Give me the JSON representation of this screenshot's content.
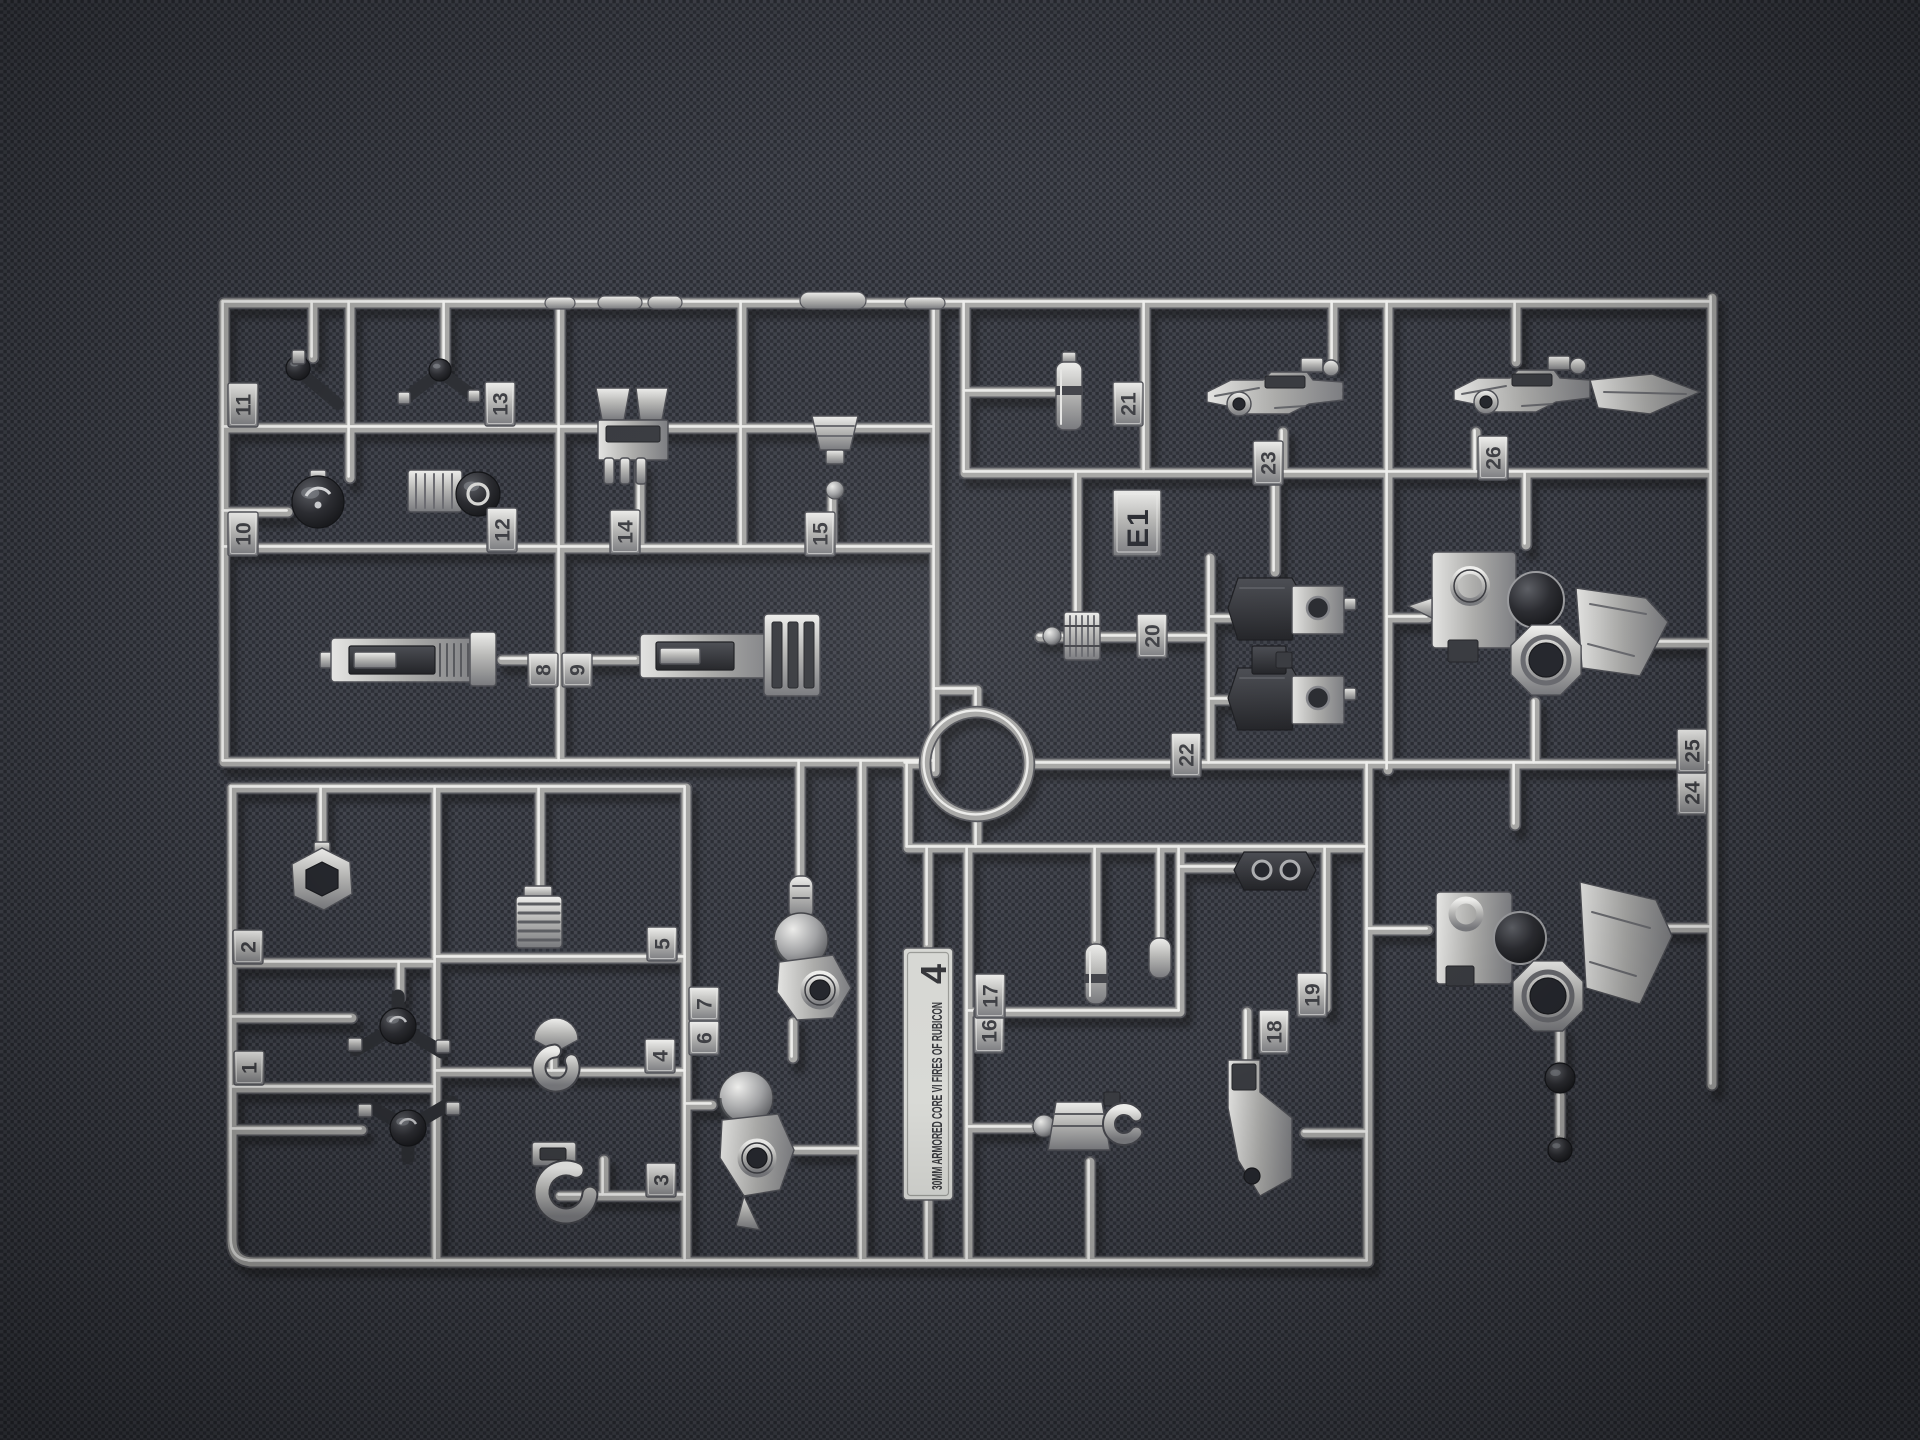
{
  "plate": {
    "series_title": "30MM ARMORED CORE VI FIRES OF RUBICON",
    "plate_number": "4"
  },
  "runner_code": "E1",
  "part_tabs": [
    {
      "label": "1",
      "x": 249,
      "y": 1068
    },
    {
      "label": "2",
      "x": 248,
      "y": 947
    },
    {
      "label": "3",
      "x": 661,
      "y": 1180
    },
    {
      "label": "4",
      "x": 660,
      "y": 1056
    },
    {
      "label": "5",
      "x": 662,
      "y": 944
    },
    {
      "label": "6",
      "x": 704,
      "y": 1038
    },
    {
      "label": "7",
      "x": 704,
      "y": 1004
    },
    {
      "label": "8",
      "x": 543,
      "y": 670
    },
    {
      "label": "9",
      "x": 577,
      "y": 670
    },
    {
      "label": "10",
      "x": 243,
      "y": 534
    },
    {
      "label": "11",
      "x": 243,
      "y": 405
    },
    {
      "label": "12",
      "x": 502,
      "y": 530
    },
    {
      "label": "13",
      "x": 500,
      "y": 404
    },
    {
      "label": "14",
      "x": 625,
      "y": 532
    },
    {
      "label": "15",
      "x": 820,
      "y": 534
    },
    {
      "label": "16",
      "x": 989,
      "y": 1031
    },
    {
      "label": "17",
      "x": 990,
      "y": 996
    },
    {
      "label": "18",
      "x": 1274,
      "y": 1032
    },
    {
      "label": "19",
      "x": 1312,
      "y": 995
    },
    {
      "label": "20",
      "x": 1152,
      "y": 636
    },
    {
      "label": "21",
      "x": 1128,
      "y": 404
    },
    {
      "label": "22",
      "x": 1186,
      "y": 755
    },
    {
      "label": "23",
      "x": 1268,
      "y": 463
    },
    {
      "label": "24",
      "x": 1692,
      "y": 793
    },
    {
      "label": "25",
      "x": 1692,
      "y": 751
    },
    {
      "label": "26",
      "x": 1493,
      "y": 458
    }
  ],
  "colors": {
    "background": "#34363d",
    "fabric_light": "#454851",
    "fabric_mid": "#3a3d45",
    "fabric_dark": "#2b2d34",
    "runner_highlight": "#efefed",
    "runner_mid": "#a9a9a7",
    "runner_dark": "#55565c",
    "part_dark": "#303237",
    "plate_fill": "#d9dad6",
    "plate_text": "#36373b",
    "tab_text": "#3f4045"
  }
}
